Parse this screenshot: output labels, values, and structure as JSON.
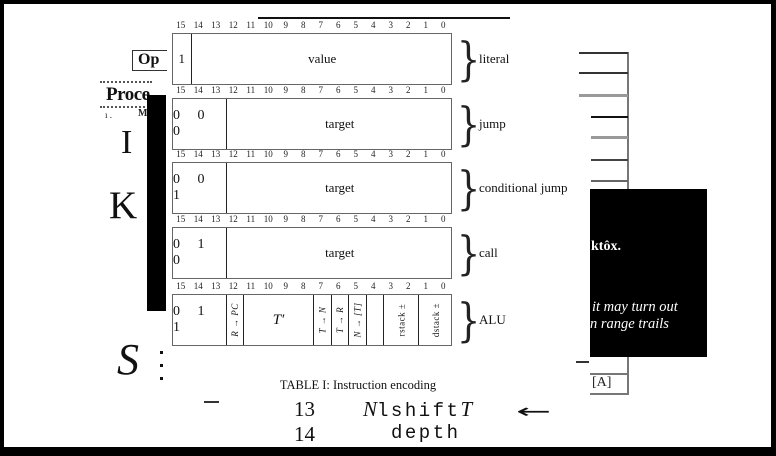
{
  "figure": {
    "bit_labels": [
      "15",
      "14",
      "13",
      "12",
      "11",
      "10",
      "9",
      "8",
      "7",
      "6",
      "5",
      "4",
      "3",
      "2",
      "1",
      "0"
    ],
    "brace": "}",
    "rows": [
      {
        "label": "literal",
        "fields": [
          {
            "text": "1",
            "bits": 1,
            "style": "plain"
          },
          {
            "text": "value",
            "bits": 15,
            "style": "plain"
          }
        ]
      },
      {
        "label": "jump",
        "fields": [
          {
            "text": "0 0 0",
            "bits": 3,
            "style": "spaced"
          },
          {
            "text": "target",
            "bits": 13,
            "style": "plain"
          }
        ]
      },
      {
        "label": "conditional jump",
        "fields": [
          {
            "text": "0 0 1",
            "bits": 3,
            "style": "spaced"
          },
          {
            "text": "target",
            "bits": 13,
            "style": "plain"
          }
        ]
      },
      {
        "label": "call",
        "fields": [
          {
            "text": "0 1 0",
            "bits": 3,
            "style": "spaced"
          },
          {
            "text": "target",
            "bits": 13,
            "style": "plain"
          }
        ]
      },
      {
        "label": "ALU",
        "fields": [
          {
            "text": "0 1 1",
            "bits": 3,
            "style": "spaced"
          },
          {
            "text": "R → PC",
            "bits": 1,
            "style": "rotated-italic"
          },
          {
            "text": "T′",
            "bits": 4,
            "style": "italic"
          },
          {
            "text": "T → N",
            "bits": 1,
            "style": "rotated-italic"
          },
          {
            "text": "T → R",
            "bits": 1,
            "style": "rotated-italic"
          },
          {
            "text": "N → [T]",
            "bits": 1,
            "style": "rotated-italic"
          },
          {
            "text": "",
            "bits": 1,
            "style": "plain"
          },
          {
            "text": "rstack ±",
            "bits": 2,
            "style": "rotated"
          },
          {
            "text": "dstack ±",
            "bits": 2,
            "style": "rotated"
          }
        ]
      }
    ],
    "caption": "TABLE I: Instruction encoding"
  },
  "listing": {
    "arrow_glyph": "←",
    "lines": [
      {
        "num": "13",
        "segments": [
          {
            "text": "N",
            "style": "math"
          },
          {
            "text": "lshift",
            "style": "code"
          },
          {
            "text": "T",
            "style": "math"
          }
        ],
        "has_arrow": true
      },
      {
        "num": "14",
        "segments": [
          {
            "text": "depth",
            "style": "code"
          }
        ],
        "has_arrow": false
      }
    ]
  },
  "underlying_page": {
    "op_label": "Op",
    "section_heading": "Proce",
    "fragments": [
      "ı .",
      "M"
    ],
    "capital_letters": [
      "I",
      "K",
      "S"
    ],
    "side_cell_label": "[A]"
  },
  "overlay_panel": {
    "line1": "ktôx.",
    "line2": "it may turn out",
    "line3": "n range trails",
    "bg": "#000000",
    "fg": "#ffffff"
  },
  "colors": {
    "box_border": "#666666",
    "divider": "#222222",
    "table_line_gray": "#999999",
    "frame": "#000000"
  }
}
